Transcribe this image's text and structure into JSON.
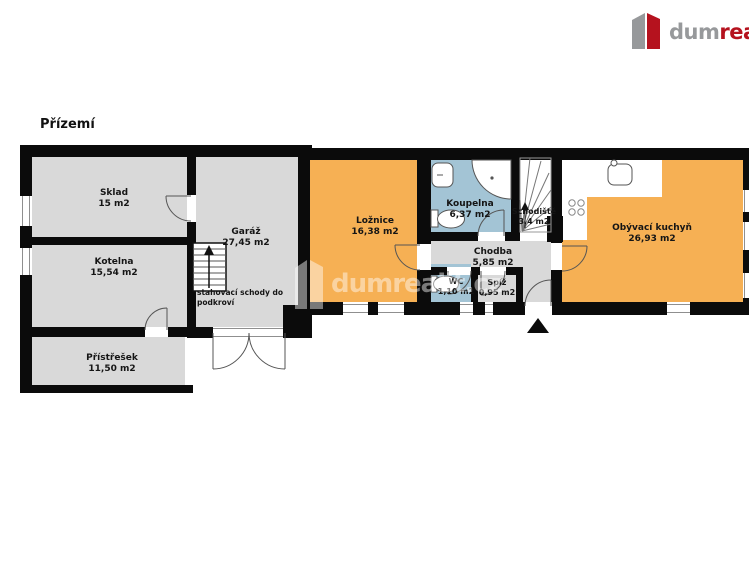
{
  "brand": {
    "word_gray": "dum",
    "word_red": "realit",
    "dot": ".",
    "tld": "cz"
  },
  "floor_title": "Přízemí",
  "watermark_text": "dumrealit.cz",
  "rooms": {
    "sklad": {
      "name": "Sklad",
      "area": "15 m2"
    },
    "kotelna": {
      "name": "Kotelna",
      "area": "15,54 m2"
    },
    "garaz": {
      "name": "Garáž",
      "area": "27,45 m2"
    },
    "pristresek": {
      "name": "Přístřešek",
      "area": "11,50 m2"
    },
    "loznice": {
      "name": "Ložnice",
      "area": "16,38 m2"
    },
    "koupelna": {
      "name": "Koupelna",
      "area": "6,37 m2"
    },
    "schodiste": {
      "name": "Schodiště",
      "area": "3,4 m2"
    },
    "chodba": {
      "name": "Chodba",
      "area": "5,85 m2"
    },
    "wc": {
      "name": "WC",
      "area": "1,10 m2"
    },
    "spiz": {
      "name": "Spíž",
      "area": "0,95 m2"
    },
    "kuchyn": {
      "name": "Obývací kuchyň",
      "area": "26,93 m2"
    }
  },
  "notes": {
    "attic_stairs_line1": "stahovací schody do",
    "attic_stairs_line2": "podkroví"
  },
  "colors": {
    "wall": "#0b0b0b",
    "room_gray": "#d9d9d9",
    "room_orange": "#f6b054",
    "room_blue": "#a3c4d5",
    "brand_red": "#b5121e",
    "brand_gray": "#97999b",
    "watermark": "#ffffff"
  }
}
